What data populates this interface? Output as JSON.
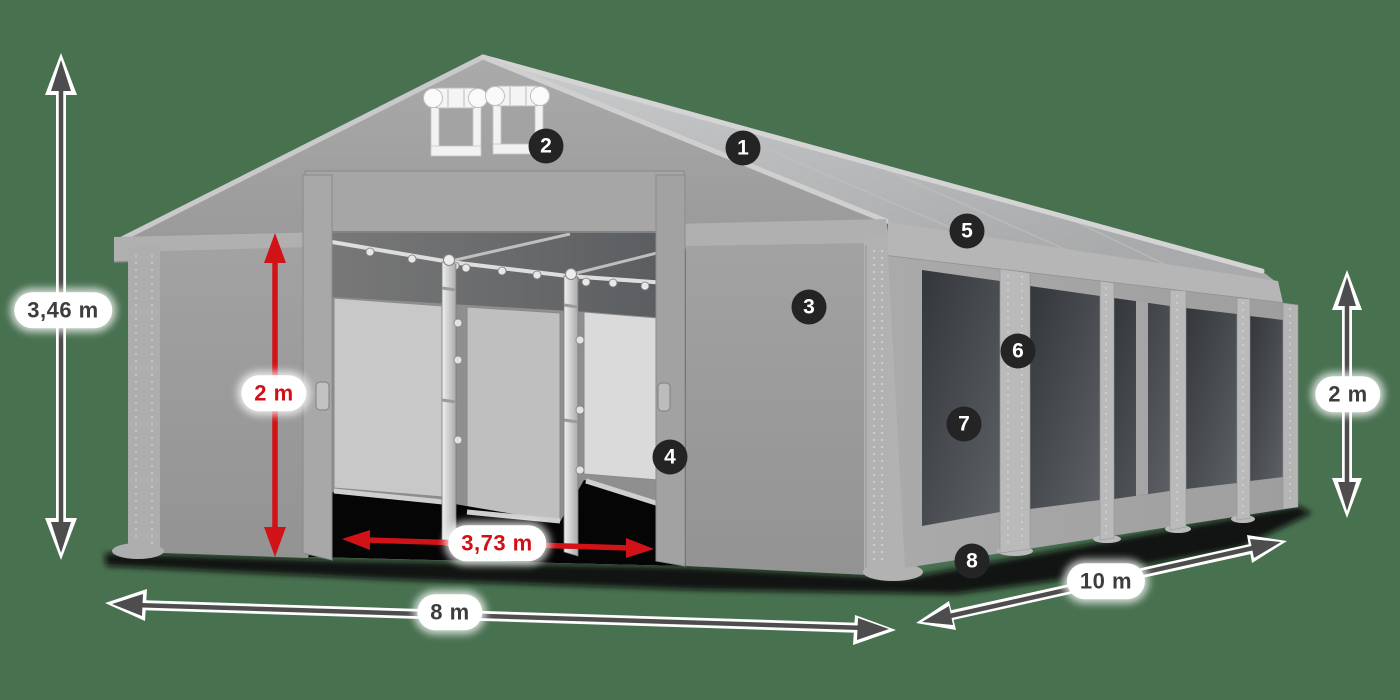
{
  "scene": {
    "description": "Party tent 8 x 10 m product illustration with numbered feature callouts and dimension arrows",
    "background_color": "#487150"
  },
  "palette": {
    "accent_red": "#D11318",
    "arrow_gray": "#4D4D4D",
    "badge_background": "#242424",
    "badge_text": "#FFFFFF",
    "label_background": "#FFFFFF",
    "label_text_dark": "#3D3D3D",
    "label_text_red": "#CF1117",
    "tent_fabric_gray": "#A5A5A5",
    "window_mesh_dark": "#44484C"
  },
  "dimensions": {
    "overall_height": {
      "value": "3,46 m"
    },
    "entrance_height": {
      "value": "2 m"
    },
    "entrance_width": {
      "value": "3,73 m"
    },
    "gable_width": {
      "value": "8 m"
    },
    "side_length": {
      "value": "10 m"
    },
    "side_wall_height": {
      "value": "2 m"
    }
  },
  "feature_callouts": {
    "badges": [
      "1",
      "2",
      "3",
      "4",
      "5",
      "6",
      "7",
      "8"
    ]
  }
}
